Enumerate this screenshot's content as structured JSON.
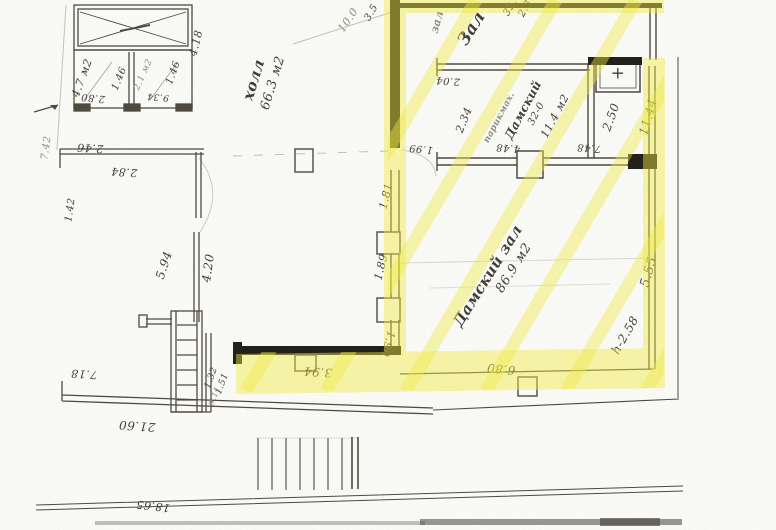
{
  "palette": {
    "paper": "#fbfbf8",
    "ink": "#4b463c",
    "black_wall": "#1d1b15",
    "pencil": "#97917f",
    "highlight": "#f1ec3f"
  },
  "labels": [
    {
      "id": "area-4-7",
      "text": "4.7 м2",
      "x": 82,
      "y": 78,
      "rot": -70,
      "size": 11
    },
    {
      "id": "dim-2-80",
      "text": "2.80",
      "x": 93,
      "y": 97,
      "rot": 185,
      "size": 10
    },
    {
      "id": "dim-1-46-a",
      "text": "1.46",
      "x": 120,
      "y": 79,
      "rot": -68,
      "size": 10
    },
    {
      "id": "area-2-1",
      "text": "2.1 м2",
      "x": 144,
      "y": 75,
      "rot": -66,
      "size": 9,
      "cls": "faint"
    },
    {
      "id": "dim-1-46-b",
      "text": "1.46",
      "x": 174,
      "y": 73,
      "rot": -70,
      "size": 10
    },
    {
      "id": "dim-9-34",
      "text": "9.34",
      "x": 158,
      "y": 96,
      "rot": 185,
      "size": 9
    },
    {
      "id": "dim-4-18",
      "text": "4.18",
      "x": 196,
      "y": 43,
      "rot": -76,
      "size": 11
    },
    {
      "id": "dim-2-46",
      "text": "2.46",
      "x": 90,
      "y": 148,
      "rot": 184,
      "size": 11
    },
    {
      "id": "dim-2-84",
      "text": "2.84",
      "x": 124,
      "y": 172,
      "rot": 184,
      "size": 11
    },
    {
      "id": "dim-7-42",
      "text": "7.42",
      "x": 47,
      "y": 148,
      "rot": -82,
      "size": 10,
      "cls": "faint"
    },
    {
      "id": "dim-1-42",
      "text": "1.42",
      "x": 71,
      "y": 210,
      "rot": -82,
      "size": 10
    },
    {
      "id": "dim-5-94",
      "text": "5.94",
      "x": 164,
      "y": 265,
      "rot": -72,
      "size": 12
    },
    {
      "id": "dim-4-20",
      "text": "4.20",
      "x": 208,
      "y": 268,
      "rot": -82,
      "size": 12
    },
    {
      "id": "dim-7-18",
      "text": "7.18",
      "x": 84,
      "y": 374,
      "rot": 184,
      "size": 11
    },
    {
      "id": "dim-21-60",
      "text": "21.60",
      "x": 137,
      "y": 426,
      "rot": 184,
      "size": 12
    },
    {
      "id": "dim-18-65",
      "text": "18.65",
      "x": 153,
      "y": 506,
      "rot": 187,
      "size": 11
    },
    {
      "id": "dim-1-32",
      "text": "1.32",
      "x": 212,
      "y": 378,
      "rot": -70,
      "size": 9
    },
    {
      "id": "dim-1-51",
      "text": "1.51",
      "x": 223,
      "y": 384,
      "rot": -70,
      "size": 9
    },
    {
      "id": "dim-9-11",
      "text": "9.11",
      "x": 215,
      "y": 396,
      "rot": -70,
      "size": 8,
      "cls": "faint"
    },
    {
      "id": "room-hall",
      "text": "холл",
      "x": 254,
      "y": 80,
      "rot": -73,
      "size": 15,
      "cls": "cursive"
    },
    {
      "id": "room-hall-area",
      "text": "66.3 м2",
      "x": 273,
      "y": 83,
      "rot": -73,
      "size": 13
    },
    {
      "id": "dim-10-0",
      "text": "10.0",
      "x": 348,
      "y": 20,
      "rot": -55,
      "size": 11,
      "cls": "faint"
    },
    {
      "id": "dim-3-5",
      "text": "3.5",
      "x": 372,
      "y": 13,
      "rot": -60,
      "size": 10
    },
    {
      "id": "label-zal-faint",
      "text": "зал",
      "x": 437,
      "y": 22,
      "rot": -75,
      "size": 11,
      "cls": "faint cursive"
    },
    {
      "id": "label-zal",
      "text": "Зал",
      "x": 472,
      "y": 29,
      "rot": -58,
      "size": 17,
      "cls": "cursive"
    },
    {
      "id": "dim-32",
      "text": "32.",
      "x": 511,
      "y": 8,
      "rot": -60,
      "size": 10
    },
    {
      "id": "dim-2-3",
      "text": "2.3",
      "x": 526,
      "y": 9,
      "rot": -60,
      "size": 10
    },
    {
      "id": "dim-2-04",
      "text": "2.04",
      "x": 448,
      "y": 80,
      "rot": 184,
      "size": 10
    },
    {
      "id": "dim-2-34",
      "text": "2.34",
      "x": 464,
      "y": 120,
      "rot": -68,
      "size": 11
    },
    {
      "id": "label-parikmah",
      "text": "парикмах.",
      "x": 500,
      "y": 118,
      "rot": -62,
      "size": 9,
      "cls": "faint cursive"
    },
    {
      "id": "room-damsky-top",
      "text": "Дамский",
      "x": 523,
      "y": 110,
      "rot": -62,
      "size": 12,
      "cls": "cursive"
    },
    {
      "id": "dim-32-0",
      "text": "32-0",
      "x": 537,
      "y": 114,
      "rot": -62,
      "size": 10
    },
    {
      "id": "area-11-4",
      "text": "11.4 м2",
      "x": 555,
      "y": 116,
      "rot": -62,
      "size": 11
    },
    {
      "id": "dim-4-48",
      "text": "4.48",
      "x": 508,
      "y": 147,
      "rot": 184,
      "size": 10
    },
    {
      "id": "dim-7-48",
      "text": "7.48",
      "x": 589,
      "y": 147,
      "rot": 184,
      "size": 10
    },
    {
      "id": "dim-2-50",
      "text": "2.50",
      "x": 611,
      "y": 117,
      "rot": -70,
      "size": 12
    },
    {
      "id": "dim-11-44",
      "text": "11.44",
      "x": 648,
      "y": 117,
      "rot": -74,
      "size": 12
    },
    {
      "id": "dim-1-99",
      "text": "1.99",
      "x": 421,
      "y": 148,
      "rot": 186,
      "size": 10
    },
    {
      "id": "dim-1-81",
      "text": "1.81",
      "x": 386,
      "y": 196,
      "rot": -76,
      "size": 11
    },
    {
      "id": "dim-1-89",
      "text": "1.89",
      "x": 381,
      "y": 267,
      "rot": -76,
      "size": 11
    },
    {
      "id": "dim-1-90",
      "text": "1.90",
      "x": 388,
      "y": 344,
      "rot": 105,
      "size": 11
    },
    {
      "id": "dim-3-94",
      "text": "3.94",
      "x": 318,
      "y": 372,
      "rot": 184,
      "size": 12
    },
    {
      "id": "dim-6-80",
      "text": "6.80",
      "x": 501,
      "y": 369,
      "rot": 186,
      "size": 12
    },
    {
      "id": "room-damsky-zal",
      "text": "Дамский зал",
      "x": 488,
      "y": 276,
      "rot": -58,
      "size": 15,
      "cls": "cursive"
    },
    {
      "id": "room-damsky-area",
      "text": "86.9 м2",
      "x": 514,
      "y": 268,
      "rot": -58,
      "size": 13
    },
    {
      "id": "dim-h-2-58",
      "text": "h-2.58",
      "x": 625,
      "y": 335,
      "rot": -60,
      "size": 12
    },
    {
      "id": "dim-5-55",
      "text": "5.55",
      "x": 649,
      "y": 272,
      "rot": -74,
      "size": 13
    },
    {
      "id": "plus-sign",
      "text": "+",
      "x": 618,
      "y": 74,
      "rot": 0,
      "size": 17
    }
  ]
}
